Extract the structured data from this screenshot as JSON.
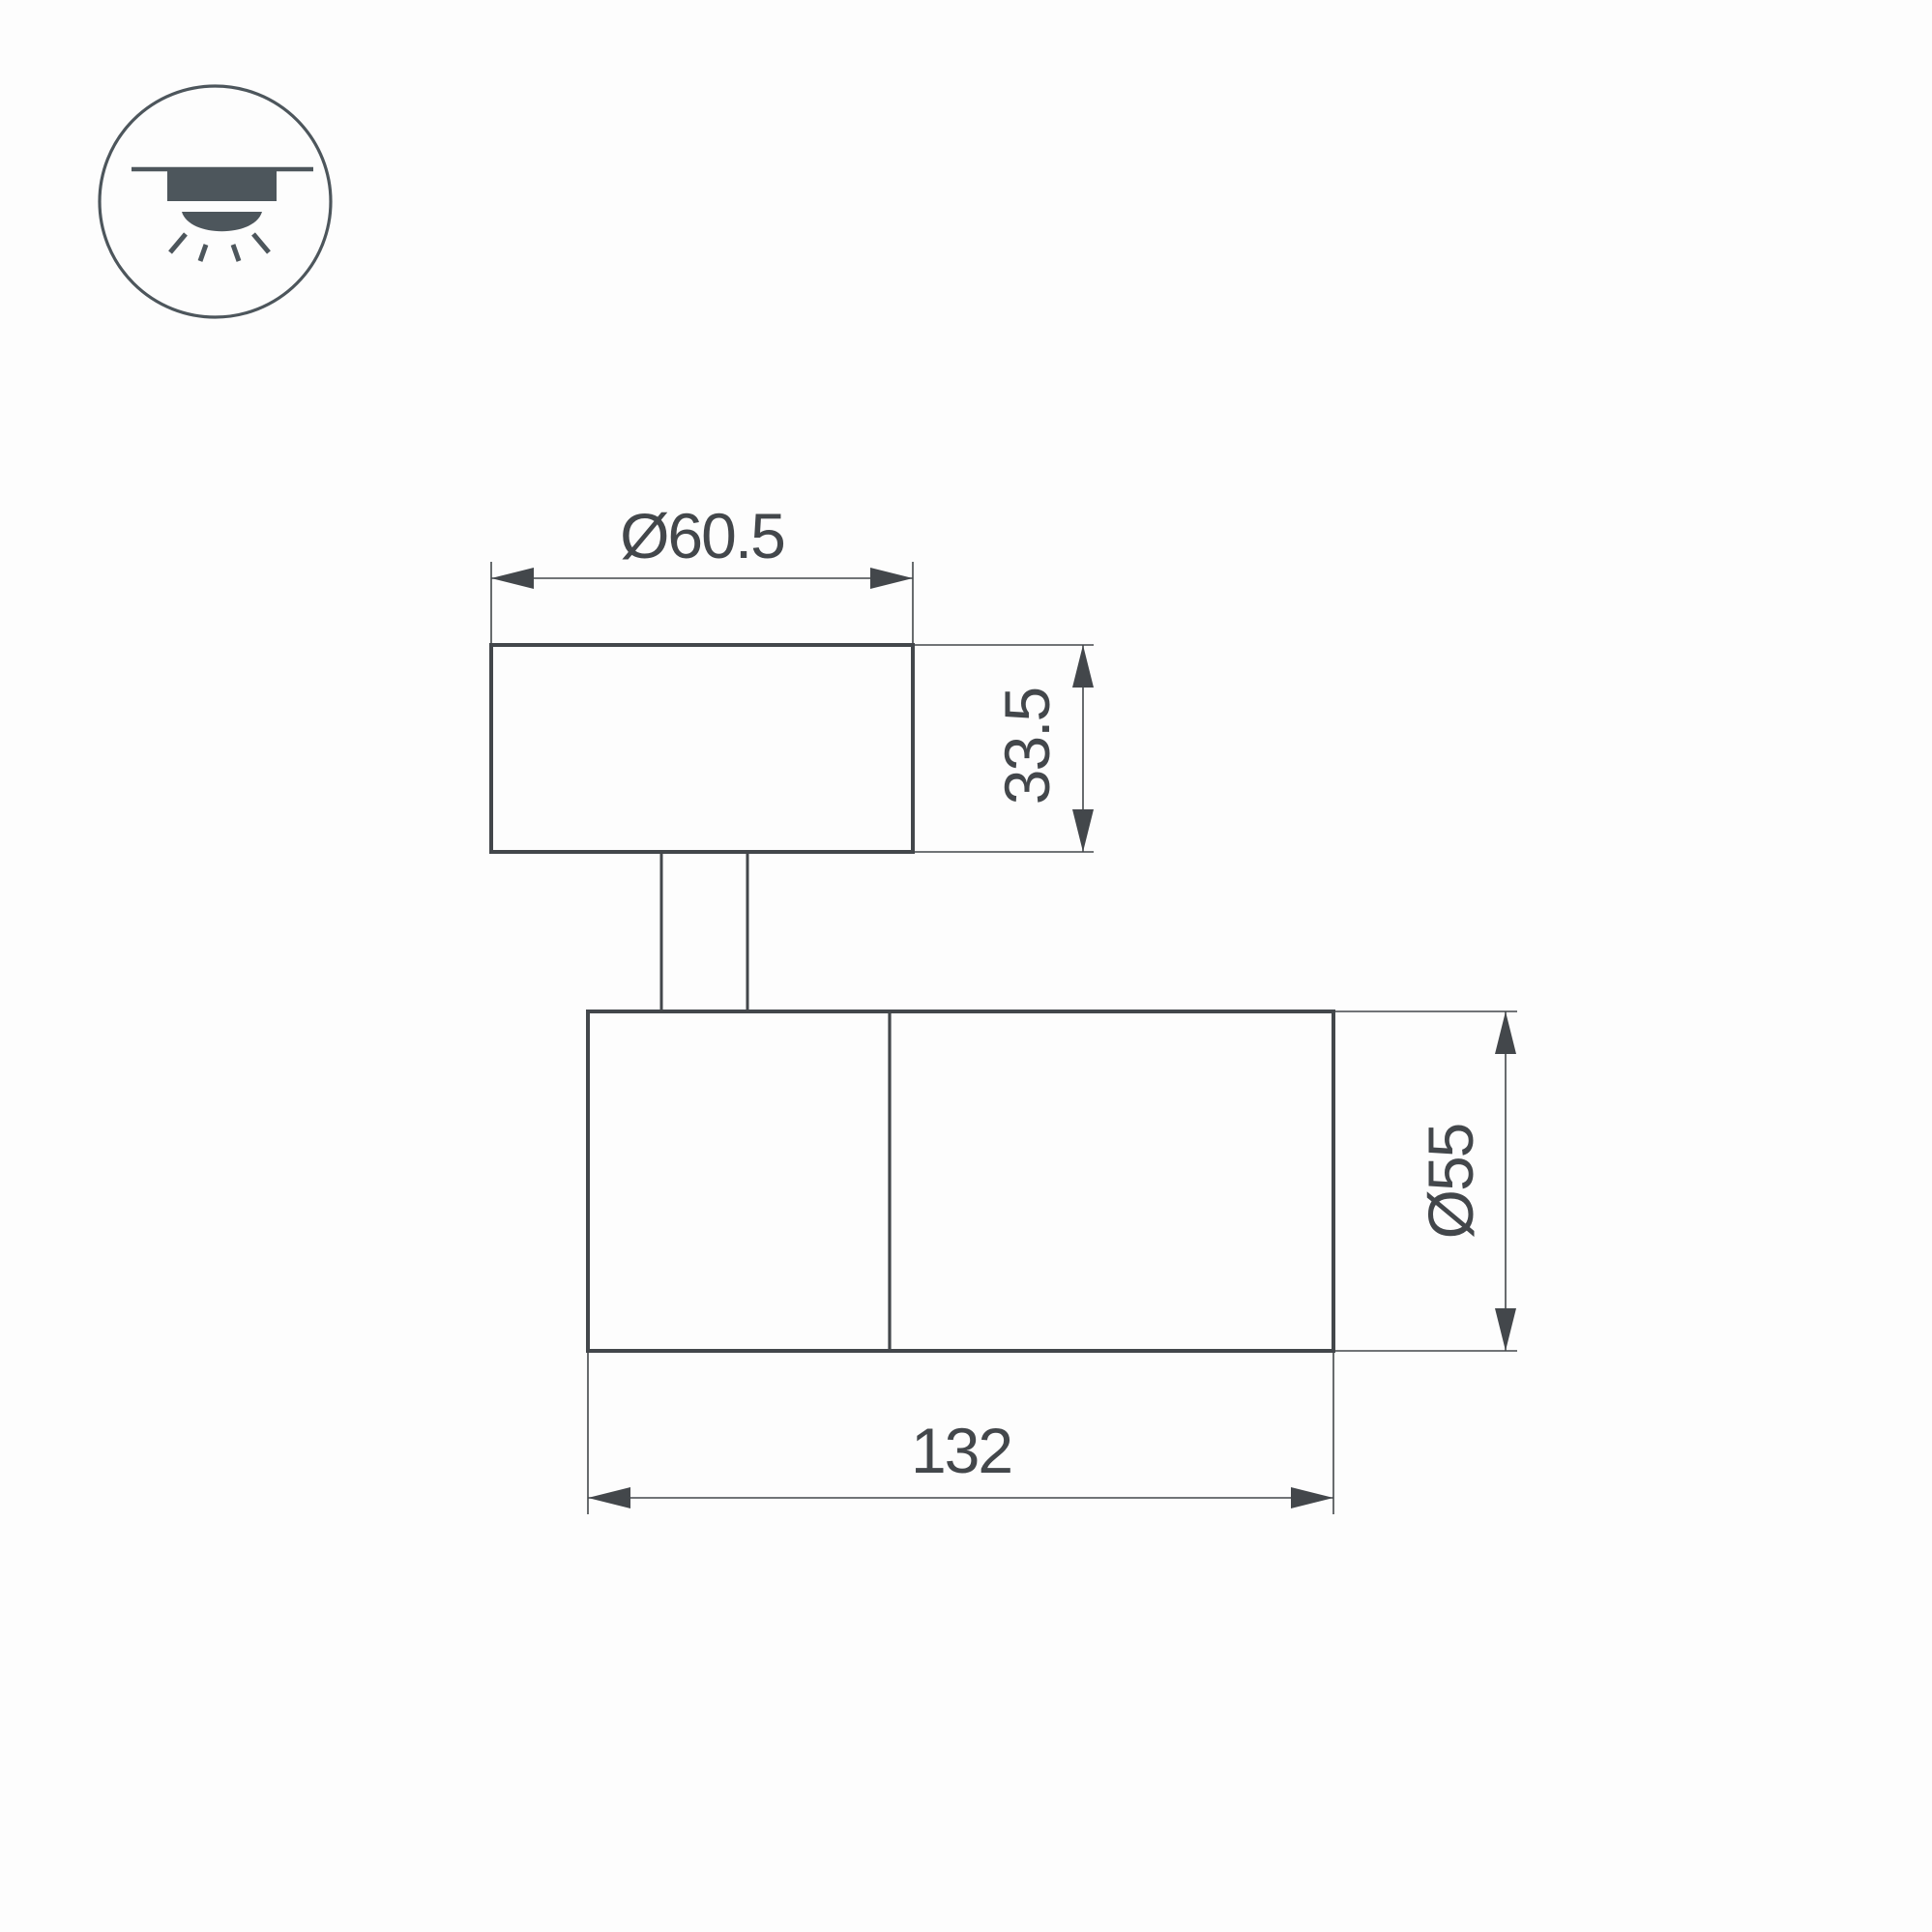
{
  "drawing": {
    "labels": {
      "base_diameter": "Ø60.5",
      "base_height": "33.5",
      "body_diameter": "Ø55",
      "body_length": "132"
    },
    "colors": {
      "line": "#43474b",
      "icon": "#4d565c",
      "bg": "#fdfdfd"
    },
    "icon": {
      "name": "ceiling-surface-mount-light-icon"
    }
  }
}
